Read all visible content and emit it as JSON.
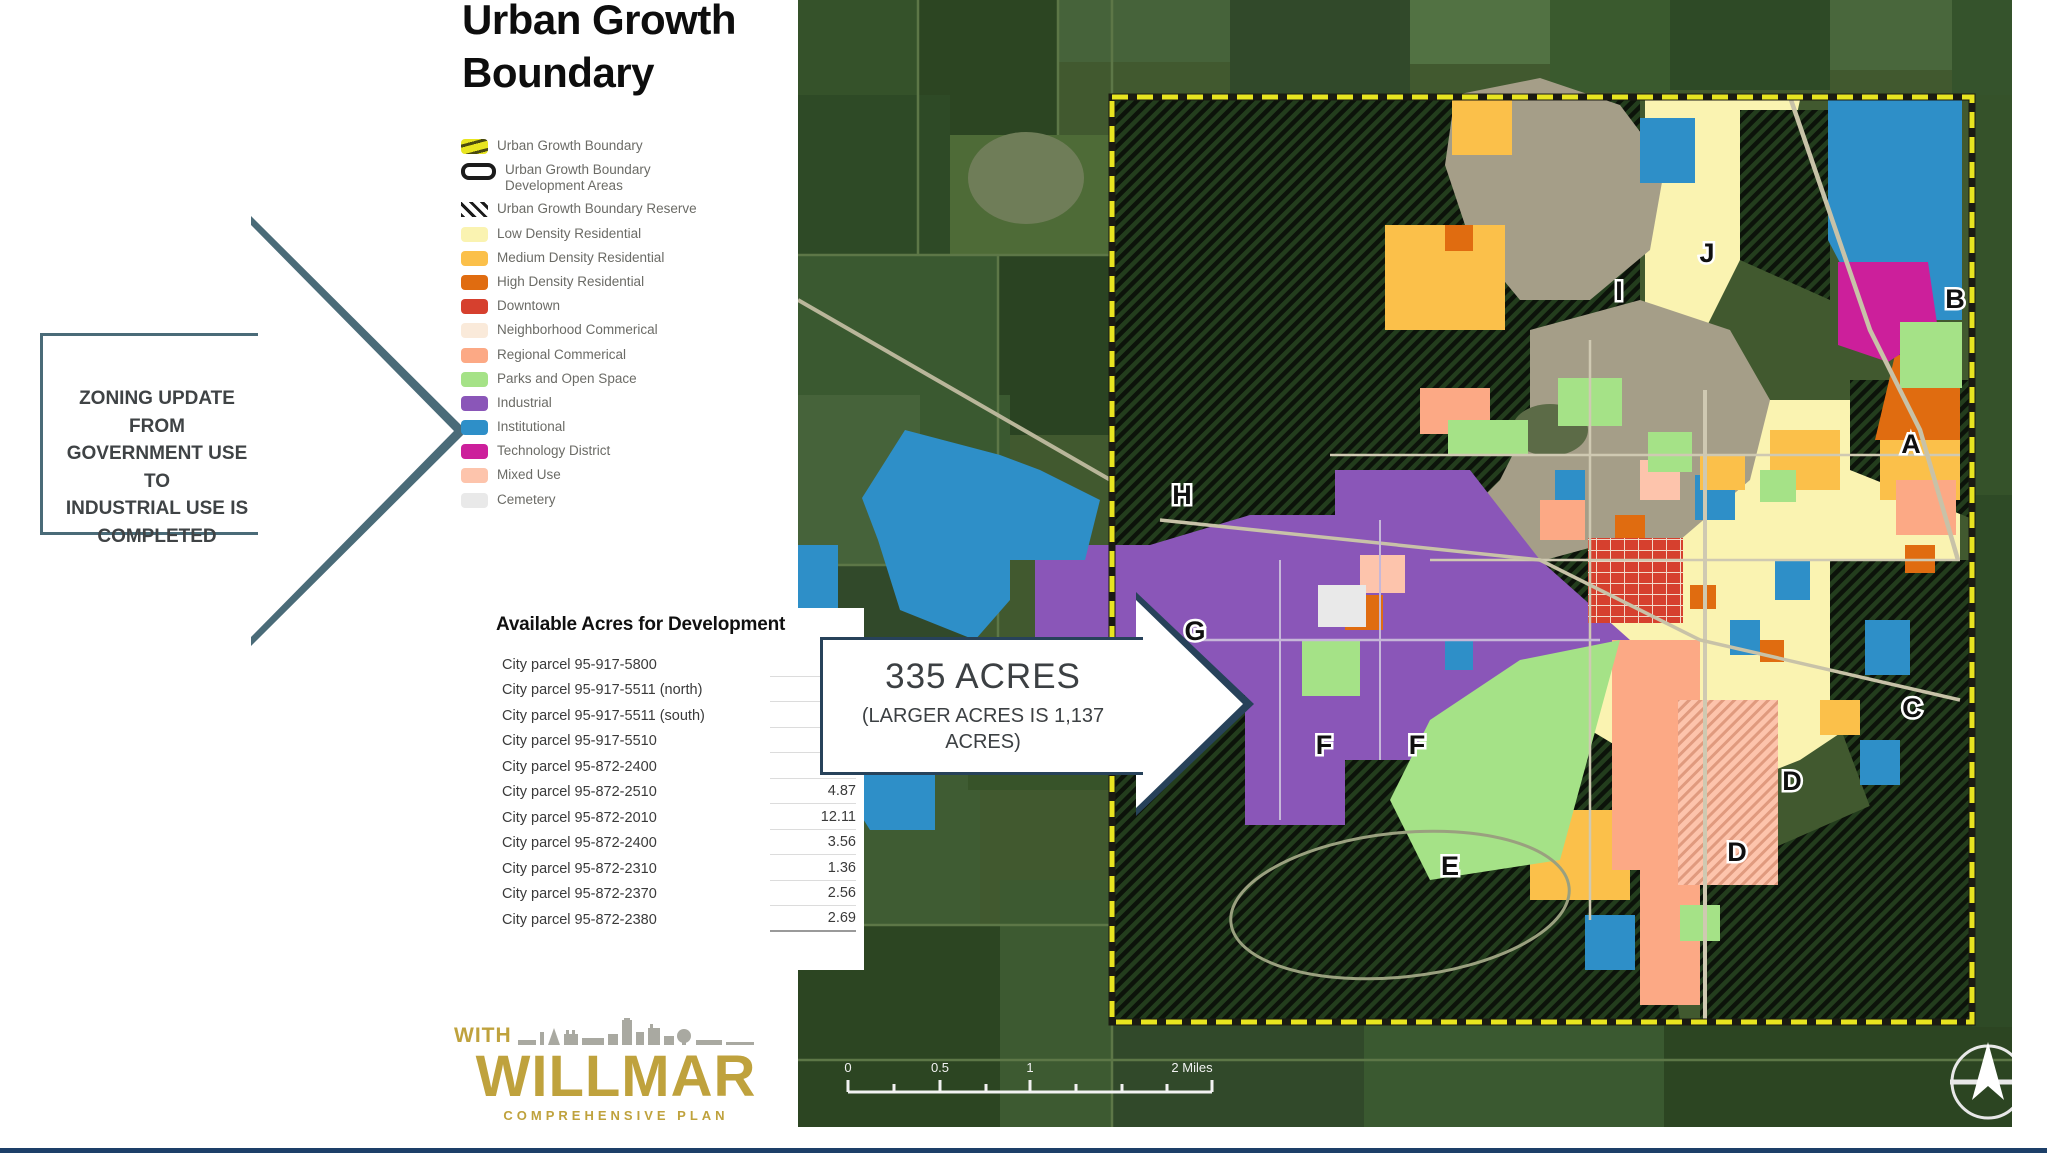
{
  "title": "Urban Growth Boundary",
  "callout_left": {
    "lines": [
      "ZONING UPDATE FROM",
      "GOVERNMENT USE TO",
      "INDUSTRIAL USE IS",
      "COMPLETED"
    ]
  },
  "callout_map": {
    "line1": "335 ACRES",
    "line2": "(LARGER ACRES IS 1,137 ACRES)"
  },
  "legend": {
    "items": [
      {
        "label": "Urban Growth Boundary"
      },
      {
        "label": "Urban Growth Boundary Development Areas"
      },
      {
        "label": "Urban Growth Boundary Reserve"
      },
      {
        "label": "Low Density Residential"
      },
      {
        "label": "Medium Density Residential"
      },
      {
        "label": "High Density Residential"
      },
      {
        "label": "Downtown"
      },
      {
        "label": "Neighborhood Commerical"
      },
      {
        "label": "Regional Commerical"
      },
      {
        "label": "Parks and Open Space"
      },
      {
        "label": "Industrial"
      },
      {
        "label": "Institutional"
      },
      {
        "label": "Technology District"
      },
      {
        "label": "Mixed Use"
      },
      {
        "label": "Cemetery"
      }
    ]
  },
  "table": {
    "title": "Available Acres for Development",
    "rows": [
      {
        "parcel": "City parcel 95-917-5800",
        "acres": "27.06"
      },
      {
        "parcel": "City parcel 95-917-5511 (north)",
        "acres": "42"
      },
      {
        "parcel": "City parcel 95-917-5511 (south)",
        "acres": "5"
      },
      {
        "parcel": "City parcel 95-917-5510",
        "acres": "6.39"
      },
      {
        "parcel": "City parcel 95-872-2400",
        "acres": "3.56"
      },
      {
        "parcel": "City parcel 95-872-2510",
        "acres": "4.87"
      },
      {
        "parcel": "City parcel 95-872-2010",
        "acres": "12.11"
      },
      {
        "parcel": "City parcel 95-872-2400",
        "acres": "3.56"
      },
      {
        "parcel": "City parcel 95-872-2310",
        "acres": "1.36"
      },
      {
        "parcel": "City parcel 95-872-2370",
        "acres": "2.56"
      },
      {
        "parcel": "City parcel 95-872-2380",
        "acres": "2.69"
      }
    ]
  },
  "logo": {
    "with": "WITH",
    "name": "WILLMAR",
    "tagline": "COMPREHENSIVE PLAN"
  },
  "map": {
    "letters": [
      "A",
      "B",
      "C",
      "D",
      "D",
      "E",
      "F",
      "F",
      "G",
      "H",
      "I",
      "J"
    ],
    "scale_labels": [
      "0",
      "0.5",
      "1",
      "2 Miles"
    ]
  },
  "colors": {
    "ugb_boundary": "#e8e520",
    "low_density": "#faf3b1",
    "medium_density": "#fbc04a",
    "high_density": "#e06c10",
    "downtown": "#d6402e",
    "neighborhood_commercial": "#faeada",
    "regional_commercial": "#fca985",
    "parks": "#a5e287",
    "industrial": "#8a56b8",
    "institutional": "#2e8fc8",
    "technology": "#cc1f9b",
    "mixed_use": "#fdc4ac",
    "cemetery": "#e9e9e9",
    "arrow_outline": "#4a6b78",
    "water": "#a59e88",
    "logo_gold": "#bfa23d"
  }
}
